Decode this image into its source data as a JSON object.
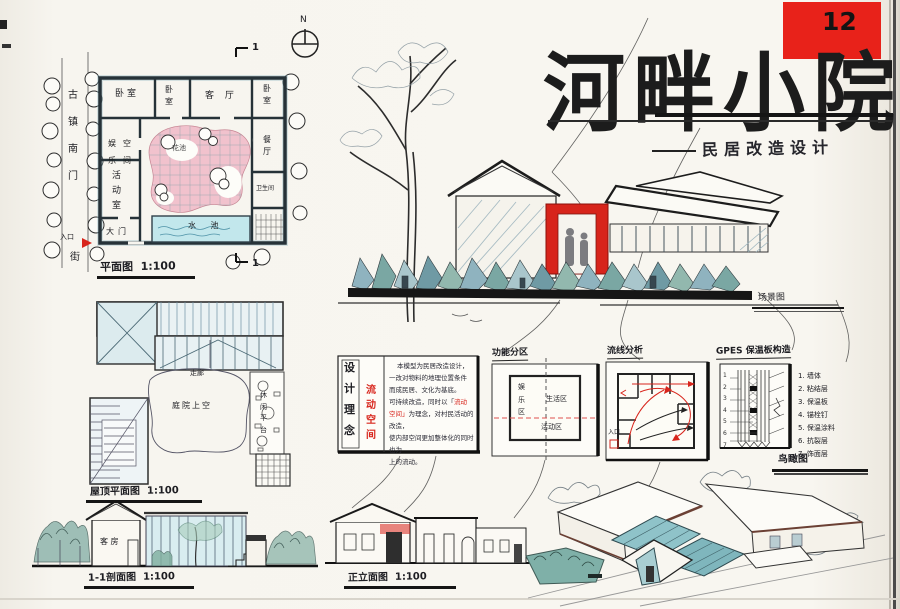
{
  "board": {
    "title_chars": [
      "河",
      "畔",
      "小",
      "院"
    ],
    "plate_number": "12",
    "subtitle": "民居改造设计",
    "colors": {
      "accent_red": "#d8251c",
      "courtyard_pink": "#f1bdca",
      "pool_blue": "#c2e7ec",
      "wash_teal": "#8fb3bf",
      "ink": "#1d1d1d",
      "paper": "#f7f5ef"
    }
  },
  "floor_plan": {
    "caption": "平面图",
    "scale": "1:100",
    "north_label": "N",
    "street_chars": [
      "古",
      "镇",
      "南",
      "门"
    ],
    "entrance_label": "入口",
    "street_suffix": "街",
    "section_marker_top": "1",
    "section_marker_bottom": "1",
    "rooms": {
      "bedroom1": "卧室",
      "bedroom2_chars": [
        "卧",
        "室"
      ],
      "living": "客 厅",
      "bedroom3_chars": [
        "卧",
        "室"
      ],
      "dining_chars": [
        "餐",
        "厅"
      ],
      "bath": "卫生间",
      "leisure_col1": [
        "娱",
        "乐"
      ],
      "leisure_col2": [
        "空",
        "间"
      ],
      "activity_chars": [
        "活",
        "动",
        "室"
      ],
      "gate": "大门",
      "flower": "花池",
      "pool": "水 池"
    }
  },
  "scene": {
    "caption": "场景图"
  },
  "roof_plan": {
    "caption": "屋顶平面图",
    "scale": "1:100",
    "labels": {
      "corridor": "走廊",
      "courtyard": "庭院上空",
      "terrace_chars": [
        "休",
        "闲",
        "平",
        "台"
      ]
    }
  },
  "concept": {
    "title_chars": [
      "设",
      "计",
      "理",
      "念"
    ],
    "keyword_chars": [
      "流",
      "动",
      "空",
      "间"
    ],
    "para": {
      "l1": "本模型为民居改造设计，",
      "l2": "一改对物料的地理位置条件",
      "l3": "而成民居、文化为基底。",
      "l4a": "可持续改造，同时以「",
      "l4b": "流动",
      "l5a": "空间」",
      "l5b": "为理念，对村民活动的改造，",
      "l6": "使内部空间更加整体化的同时也为",
      "l7": "上的流动。"
    }
  },
  "zoning": {
    "caption": "功能分区",
    "entertain_chars": [
      "娱",
      "乐",
      "区"
    ],
    "living": "生活区",
    "activity": "活动区"
  },
  "circulation": {
    "caption": "流线分析",
    "entrance": "入口"
  },
  "wall_detail": {
    "caption": "GPES 保温板构造",
    "left_nums": [
      "1",
      "2",
      "3",
      "4",
      "5",
      "6",
      "7"
    ],
    "layers": [
      "1. 墙体",
      "2. 粘结层",
      "3. 保温板",
      "4. 锚栓钉",
      "5. 保温涂料",
      "6. 抗裂层",
      "7. 饰面层"
    ]
  },
  "sections": {
    "section_caption": "1-1剖面图",
    "section_scale": "1:100",
    "elevation_caption": "正立面图",
    "elevation_scale": "1:100",
    "room_label": "客 房"
  },
  "axon": {
    "caption": "鸟瞰图"
  }
}
